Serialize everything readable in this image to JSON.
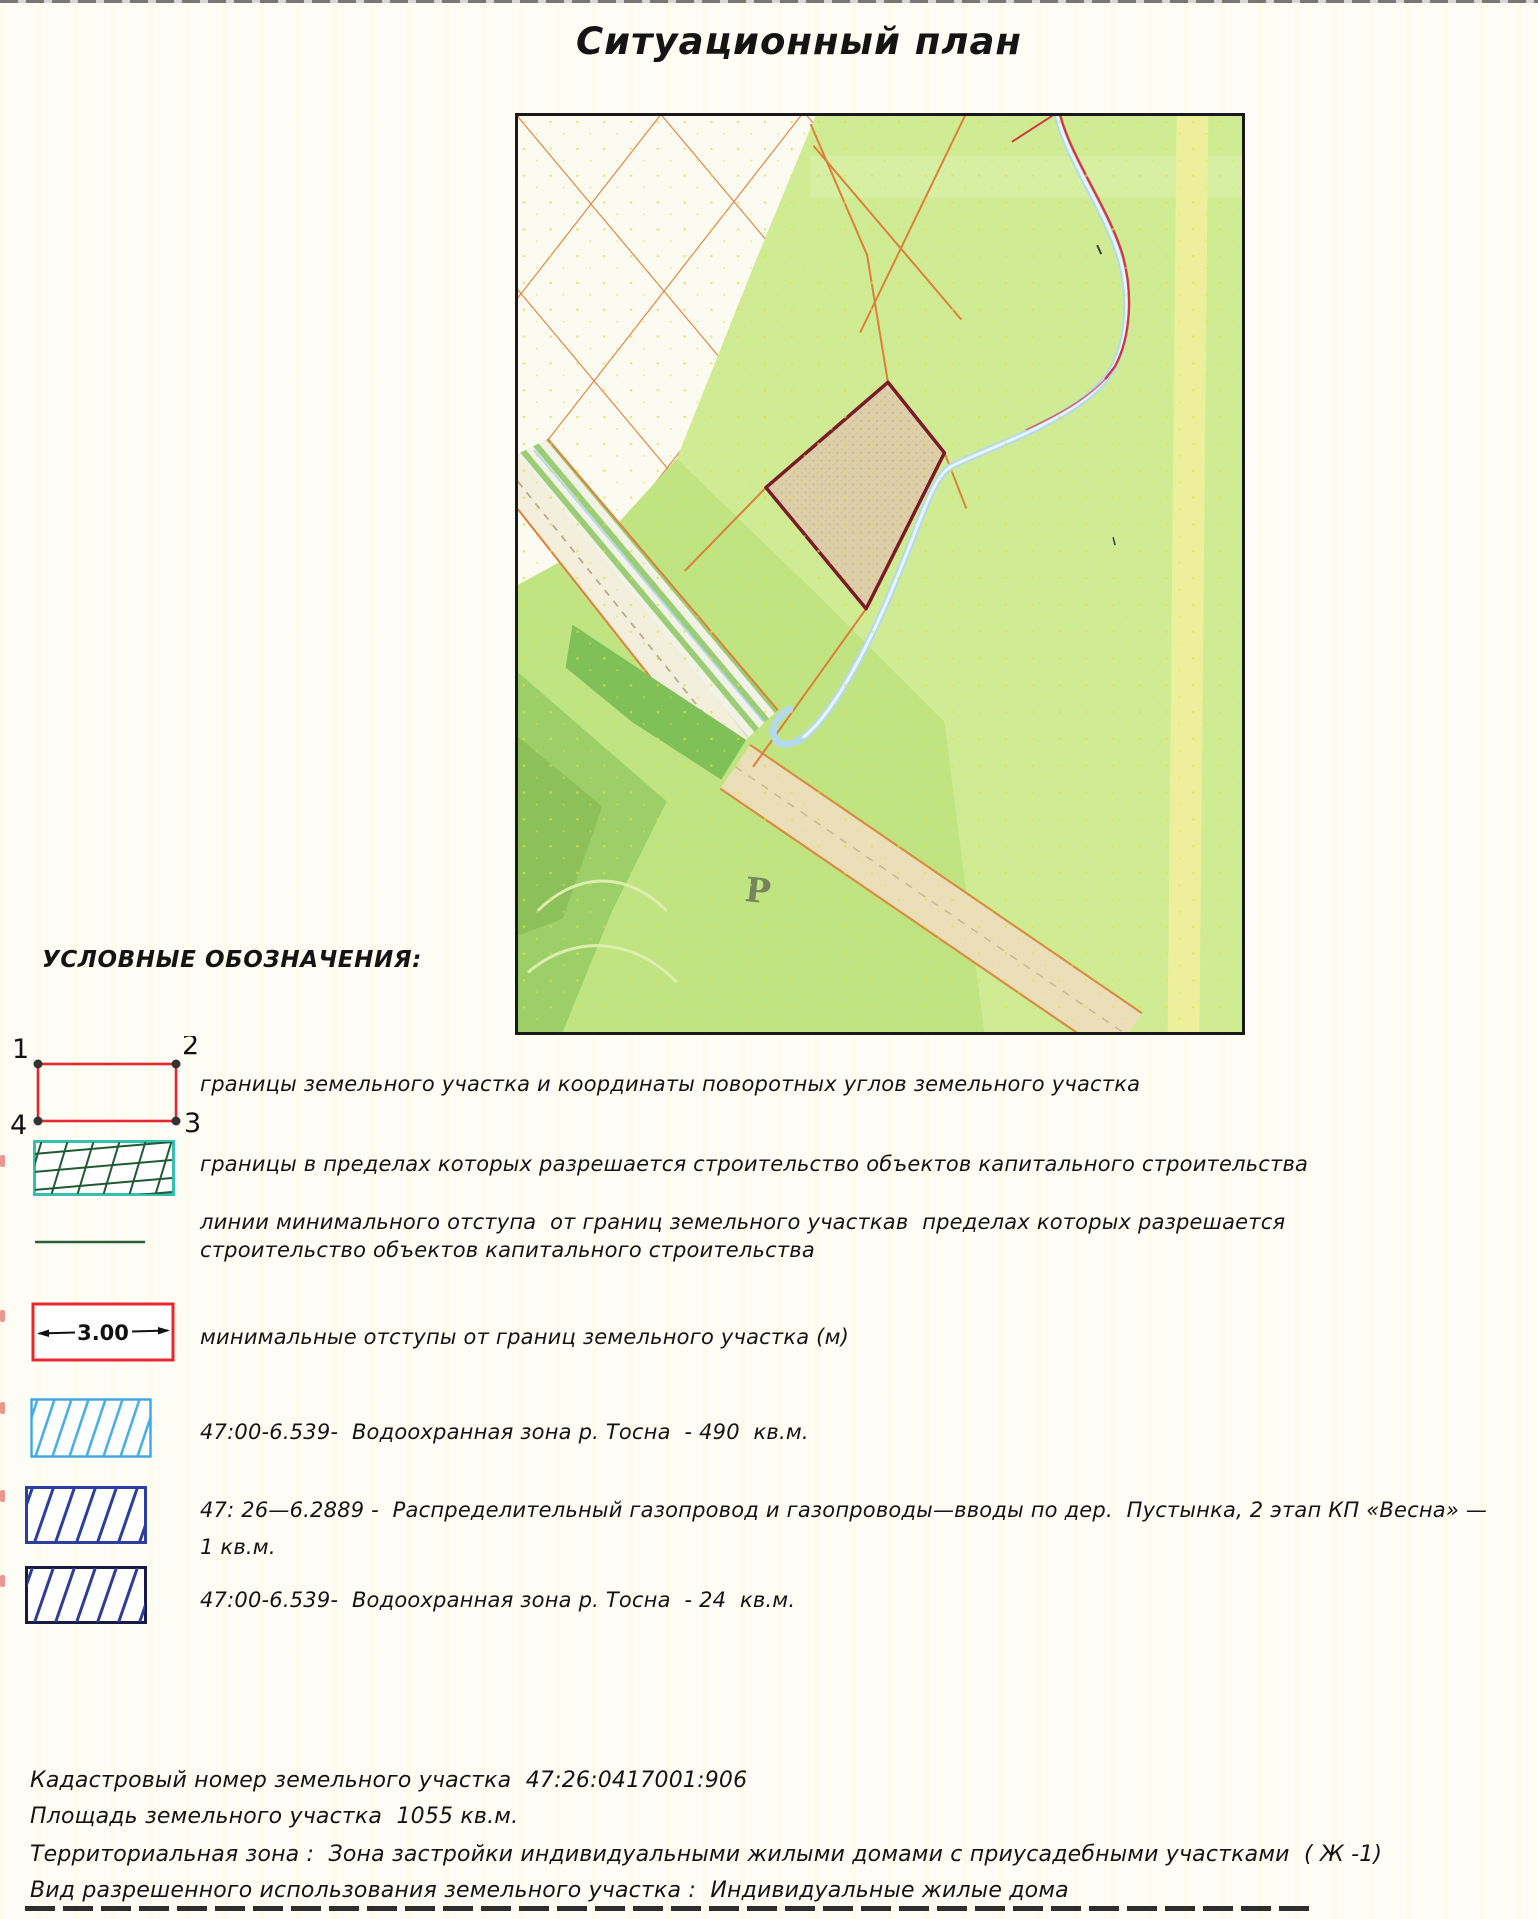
{
  "page": {
    "title": "Ситуационный план"
  },
  "map": {
    "road_label": "Р"
  },
  "legend": {
    "header": "УСЛОВНЫЕ ОБОЗНАЧЕНИЯ:",
    "items": [
      {
        "corners": [
          "1",
          "2",
          "3",
          "4"
        ],
        "label": "границы земельного участка и координаты поворотных углов земельного участка"
      },
      {
        "label": "границы в пределах которых разрешается строительство объектов капитального строительства"
      },
      {
        "label_line1": "линии минимального отступа  от границ земельного участкав  пределах которых разрешается",
        "label_line2": "строительство объектов капитального строительства"
      },
      {
        "value": "3.00",
        "label": "минимальные отступы от границ земельного участка (м)"
      },
      {
        "label": "47:00-6.539-  Водоохранная зона р. Тосна  - 490  кв.м."
      },
      {
        "label_line1": "47: 26—6.2889 -  Распределительный газопровод и газопроводы—вводы по дер.  Пустынка, 2 этап КП «Весна» —",
        "label_line2": "1 кв.м."
      },
      {
        "label": "47:00-6.539-  Водоохранная зона р. Тосна  - 24  кв.м."
      }
    ]
  },
  "details": {
    "cadastral_number_line": "Кадастровый номер земельного участка  47:26:0417001:906",
    "area_line": "Площадь земельного участка  1055 кв.м.",
    "territorial_zone_line": "Территориальная зона :  Зона застройки индивидуальными жилыми домами с приусадебными участками  ( Ж -1)",
    "permitted_use_line": "Вид разрешенного использования земельного участка :  Индивидуальные жилые дома"
  }
}
